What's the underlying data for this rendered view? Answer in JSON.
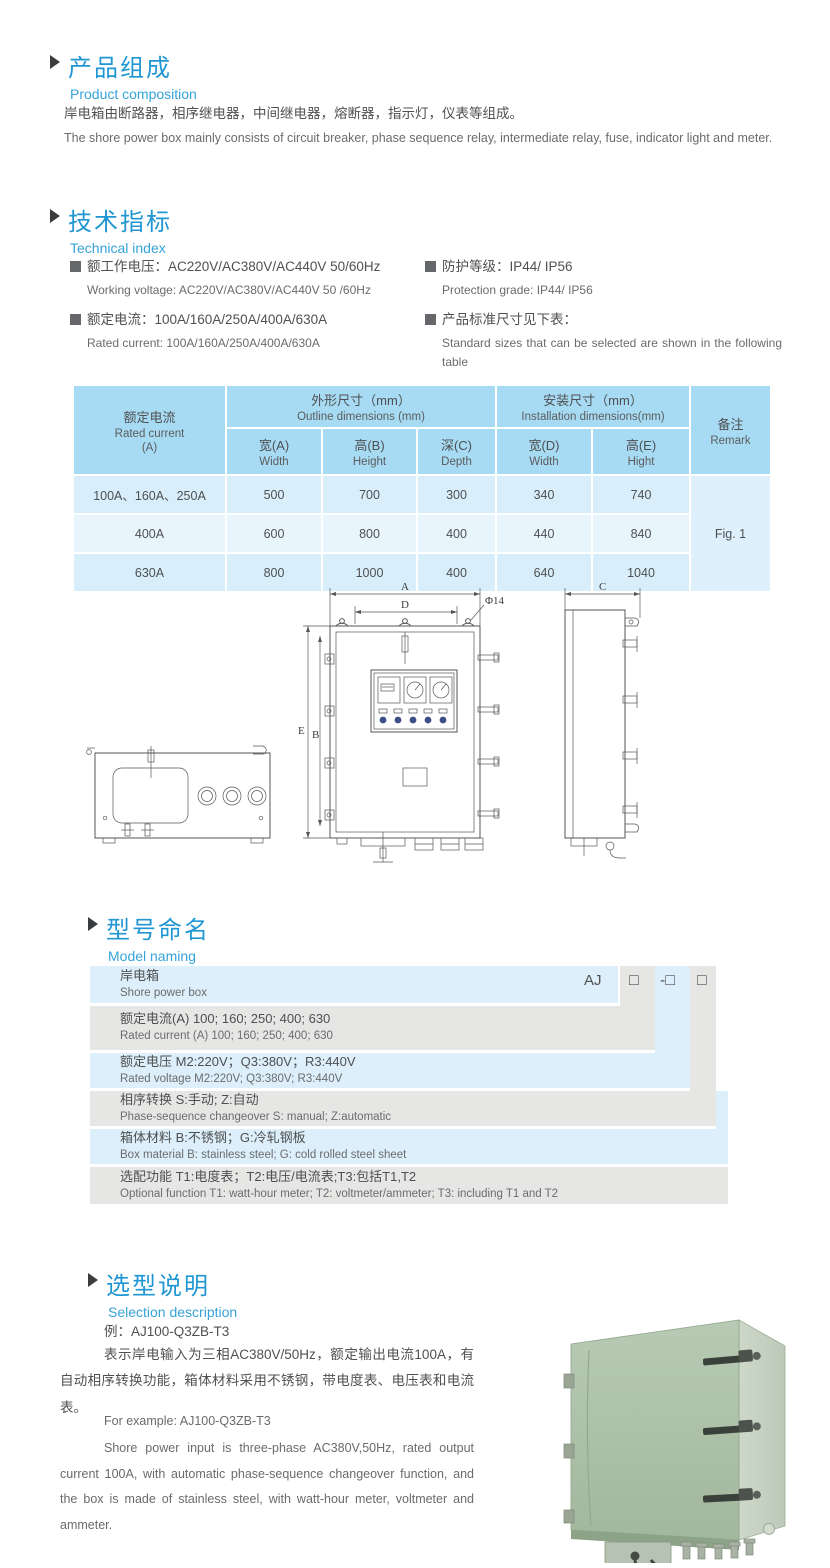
{
  "colors": {
    "accent": "#2096d3",
    "subtitle_blue": "#35a3da",
    "table_header_bg": "#a7dbf3",
    "table_row_bg": "#d8eefa",
    "table_row_alt_bg": "#e9f5fd",
    "model_blue": "#ddeffa",
    "model_gray": "#e6e6e5",
    "body_text": "#4f5052",
    "photo_green": "#adc1a9"
  },
  "composition": {
    "title_zh": "产品组成",
    "title_en": "Product  composition",
    "body_zh": "岸电箱由断路器，相序继电器，中间继电器，熔断器，指示灯，仪表等组成。",
    "body_en": "The shore power box mainly consists of circuit breaker, phase sequence relay, intermediate relay, fuse, indicator light and meter."
  },
  "technical": {
    "title_zh": "技术指标",
    "title_en": "Technical index",
    "specs_left": [
      {
        "zh": "额工作电压：AC220V/AC380V/AC440V  50/60Hz",
        "en": "Working voltage: AC220V/AC380V/AC440V 50 /60Hz"
      },
      {
        "zh": "额定电流：100A/160A/250A/400A/630A",
        "en": "Rated current: 100A/160A/250A/400A/630A"
      }
    ],
    "specs_right": [
      {
        "zh": "防护等级：IP44/ IP56",
        "en": "Protection grade: IP44/ IP56"
      },
      {
        "zh": "产品标准尺寸见下表：",
        "en": "Standard sizes that can be selected are shown in the following table"
      }
    ]
  },
  "dim_table": {
    "col_current_zh": "额定电流",
    "col_current_en": "Rated current",
    "col_current_unit": "(A)",
    "group_outline_zh": "外形尺寸（mm）",
    "group_outline_en": "Outline dimensions (mm)",
    "group_install_zh": "安装尺寸（mm）",
    "group_install_en": "Installation dimensions(mm)",
    "col_remark_zh": "备注",
    "col_remark_en": "Remark",
    "sub": [
      {
        "zh": "宽(A)",
        "en": "Width"
      },
      {
        "zh": "高(B)",
        "en": "Height"
      },
      {
        "zh": "深(C)",
        "en": "Depth"
      },
      {
        "zh": "宽(D)",
        "en": "Width"
      },
      {
        "zh": "高(E)",
        "en": "Hight"
      }
    ],
    "rows": [
      {
        "current": "100A、160A、250A",
        "a": "500",
        "b": "700",
        "c": "300",
        "d": "340",
        "e": "740"
      },
      {
        "current": "400A",
        "a": "600",
        "b": "800",
        "c": "400",
        "d": "440",
        "e": "840"
      },
      {
        "current": "630A",
        "a": "800",
        "b": "1000",
        "c": "400",
        "d": "640",
        "e": "1040"
      }
    ],
    "remark": "Fig. 1"
  },
  "drawing": {
    "labels": {
      "a": "A",
      "d": "D",
      "phi": "Φ14",
      "e": "E",
      "b": "B",
      "c": "C"
    }
  },
  "model_naming": {
    "title_zh": "型号命名",
    "title_en": "Model naming",
    "prefix": "AJ",
    "box1": "□",
    "box2": "-□",
    "box3": "□",
    "rows": [
      {
        "zh": "岸电箱",
        "en": "Shore power box"
      },
      {
        "zh": "额定电流(A)  100; 160; 250; 400; 630",
        "en": "Rated current (A) 100; 160; 250; 400; 630"
      },
      {
        "zh": "额定电压   M2:220V；Q3:380V；R3:440V",
        "en": "Rated voltage  M2:220V;  Q3:380V;  R3:440V"
      },
      {
        "zh": "相序转换  S:手动; Z:自动",
        "en": "Phase-sequence changeover  S: manual;  Z:automatic"
      },
      {
        "zh": "箱体材料    B:不锈钢；G:冷轧钢板",
        "en": "Box material   B: stainless steel; G: cold rolled steel sheet"
      },
      {
        "zh": "选配功能     T1:电度表；T2:电压/电流表;T3:包括T1,T2",
        "en": "Optional function  T1: watt-hour meter; T2: voltmeter/ammeter; T3: including T1 and T2"
      }
    ]
  },
  "selection": {
    "title_zh": "选型说明",
    "title_en": "Selection description",
    "example_zh": "例：AJ100-Q3ZB-T3",
    "para_zh": "表示岸电输入为三相AC380V/50Hz，额定输出电流100A，有自动相序转换功能，箱体材料采用不锈钢，带电度表、电压表和电流表。",
    "example_en": "For example: AJ100-Q3ZB-T3",
    "para_en": "Shore power input is three-phase AC380V,50Hz, rated output current 100A, with automatic phase-sequence changeover function, and the box is made of stainless steel, with watt-hour meter, voltmeter and ammeter."
  }
}
